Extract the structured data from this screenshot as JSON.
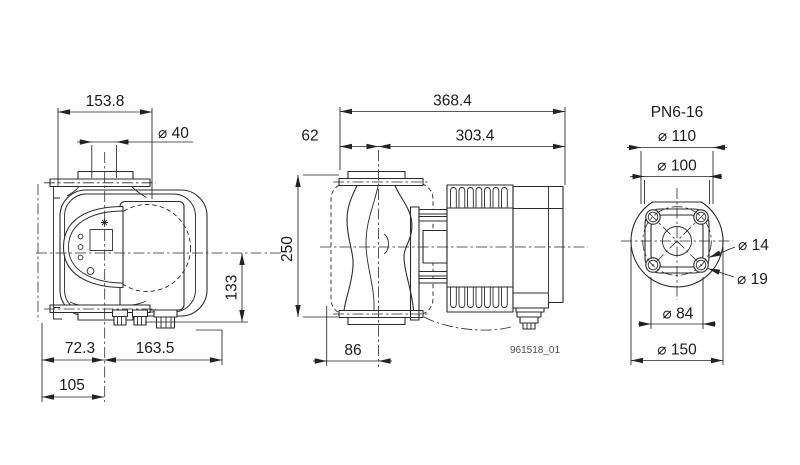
{
  "drawing": {
    "front_view": {
      "dim_overall_width": "153.8",
      "dim_port": "⌀ 40",
      "dim_height": "133",
      "dim_left": "72.3",
      "dim_right": "163.5",
      "dim_base": "105"
    },
    "side_view": {
      "dim_overall_length": "368.4",
      "dim_offset": "62",
      "dim_body": "303.4",
      "dim_port_to_port": "250",
      "dim_foot": "86",
      "drawing_number": "961518_01"
    },
    "flange_view": {
      "title": "PN6-16",
      "dim_d110": "⌀ 110",
      "dim_d100": "⌀ 100",
      "dim_hole": "⌀ 14",
      "dim_slot": "⌀ 19",
      "dim_d84": "⌀ 84",
      "dim_d150": "⌀ 150"
    },
    "colors": {
      "line": "#2b2b2b",
      "text": "#1b1b1b",
      "muted_text": "#4a4a4a",
      "background": "#ffffff"
    }
  }
}
